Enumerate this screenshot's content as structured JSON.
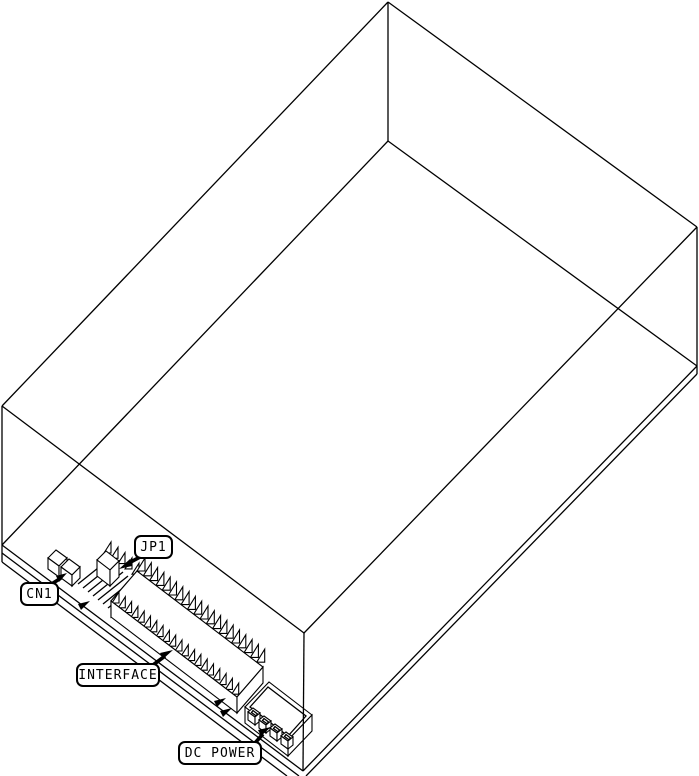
{
  "labels": {
    "jp1": "JP1",
    "cn1": "CN1",
    "interface": "INTERFACE",
    "dc_power": "DC POWER"
  },
  "colors": {
    "line": "#000000",
    "background": "#ffffff"
  }
}
